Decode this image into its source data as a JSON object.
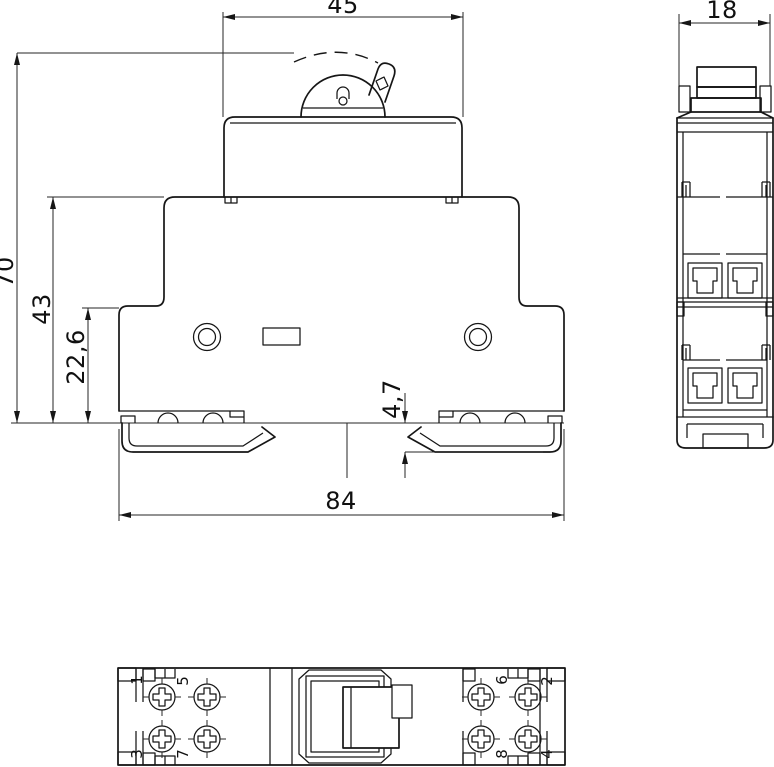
{
  "meta": {
    "background": "#ffffff",
    "line_color": "#161616",
    "drawing_type": "technical dimension drawing"
  },
  "views": {
    "front": {
      "dimensions": {
        "top_width": "45",
        "total_height": "70",
        "body_height": "43",
        "lower_height": "22,6",
        "rail_gap": "4,7",
        "total_width": "84"
      }
    },
    "side": {
      "dimensions": {
        "width": "18"
      }
    },
    "bottom": {
      "terminals": {
        "t1": "1",
        "t5": "5",
        "t3": "3",
        "t7": "7",
        "t6": "6",
        "t2": "2",
        "t8": "8",
        "t4": "4"
      }
    }
  }
}
